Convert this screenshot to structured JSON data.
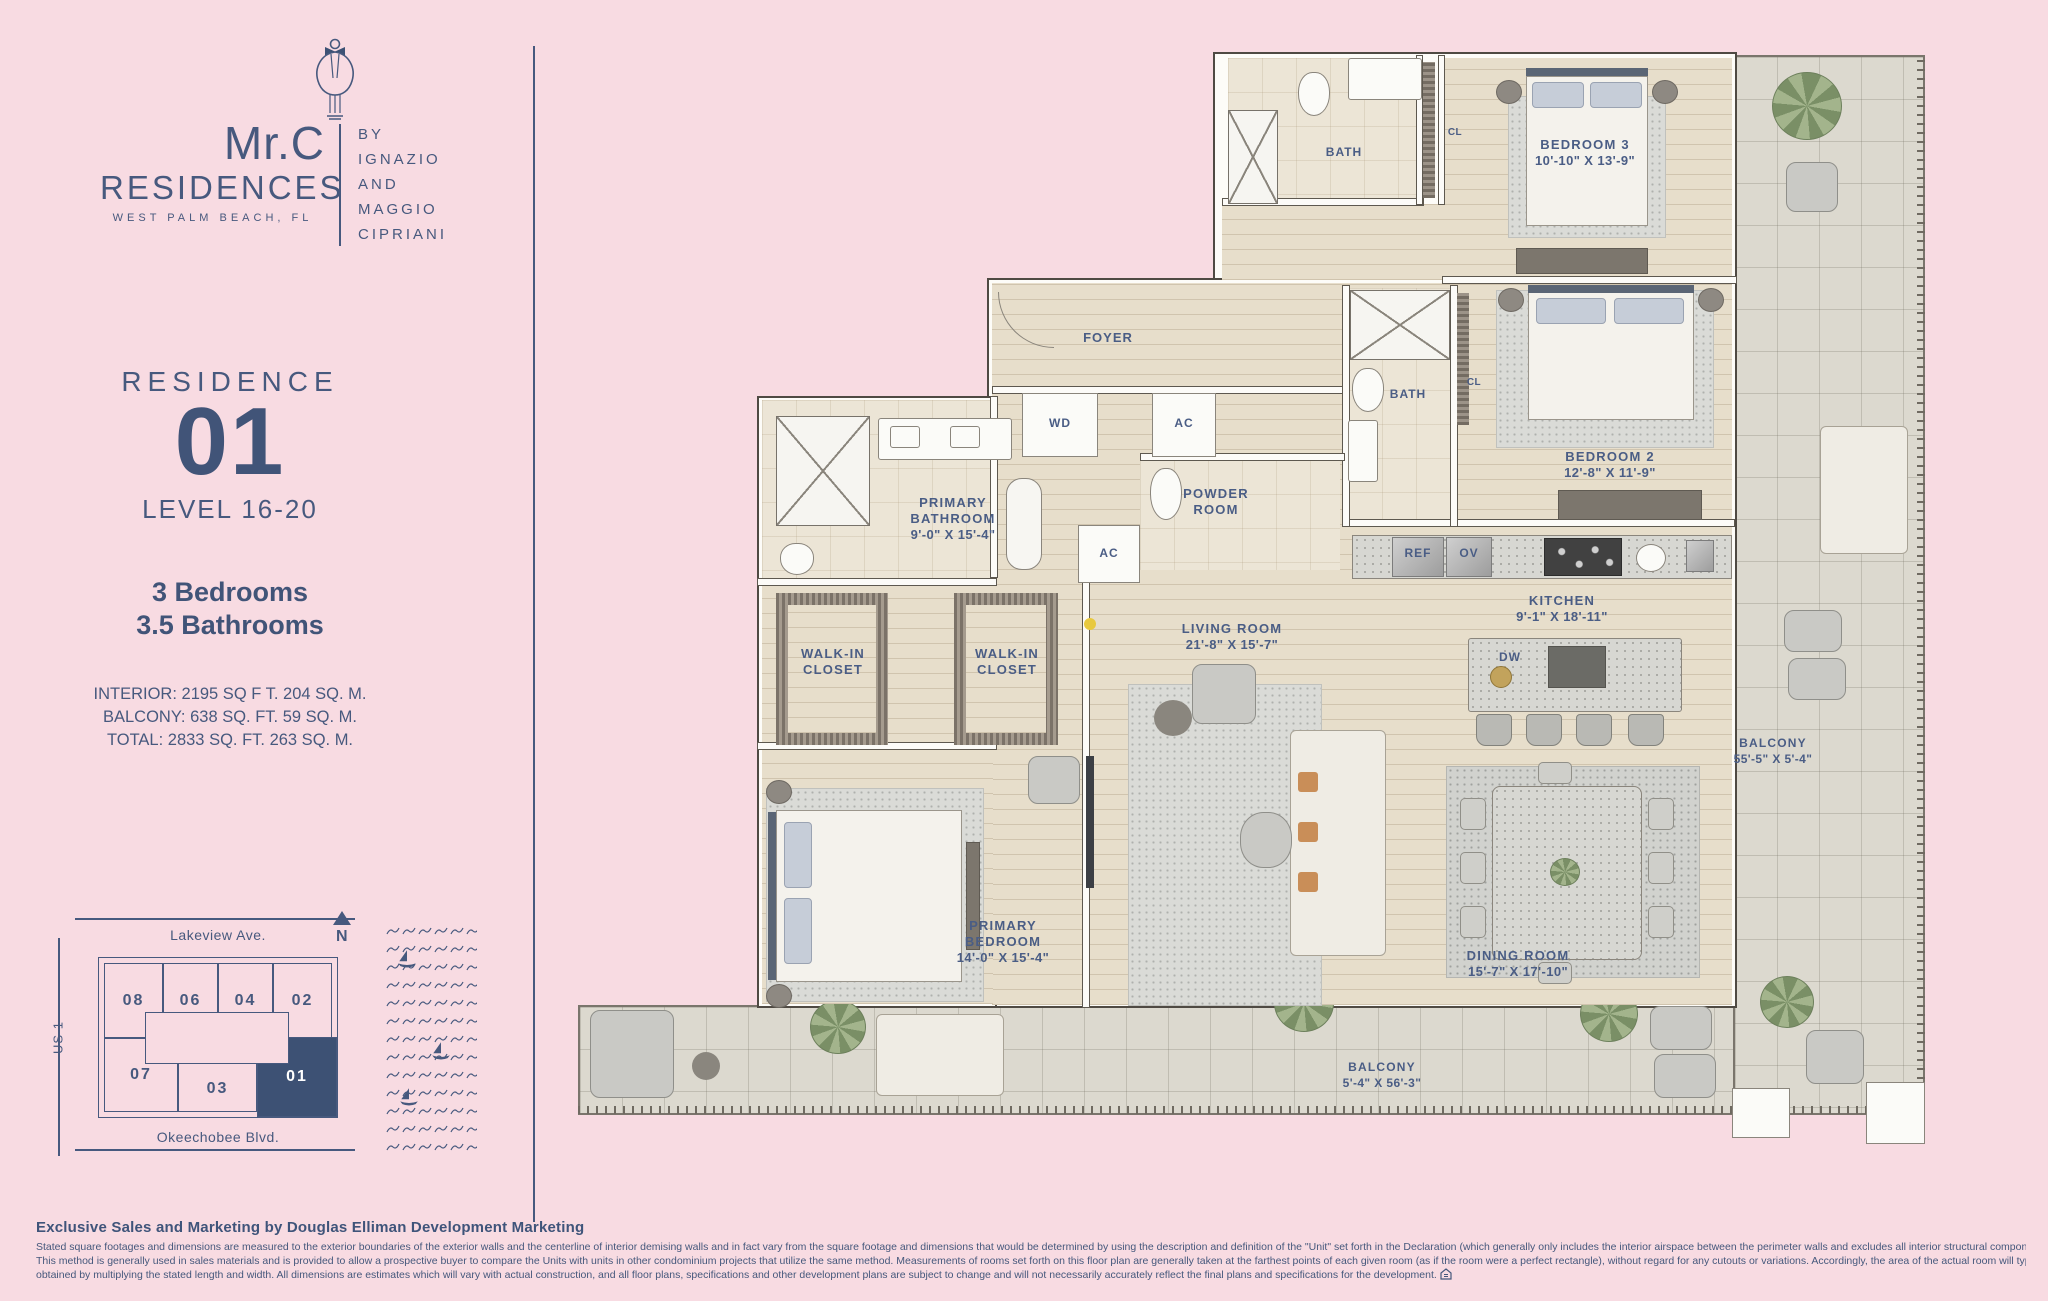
{
  "brand": {
    "name": "Mr.C",
    "residences": "RESIDENCES",
    "location": "WEST PALM BEACH, FL",
    "byline": [
      "BY",
      "IGNAZIO",
      "AND",
      "MAGGIO",
      "CIPRIANI"
    ]
  },
  "residence": {
    "label": "RESIDENCE",
    "number": "01",
    "level": "LEVEL 16-20",
    "bedrooms": "3 Bedrooms",
    "bathrooms": "3.5 Bathrooms",
    "interior": "INTERIOR: 2195 SQ F T. 204 SQ. M.",
    "balcony": "BALCONY: 638 SQ. FT. 59 SQ. M.",
    "total": "TOTAL: 2833 SQ. FT. 263 SQ. M."
  },
  "siteplan": {
    "street_top": "Lakeview Ave.",
    "street_left": "US 1",
    "street_bottom": "Okeechobee Blvd.",
    "north_label": "N",
    "units_top": [
      "08",
      "06",
      "04",
      "02"
    ],
    "units_bottom": [
      "07",
      "03",
      "01"
    ],
    "highlighted_unit": "01"
  },
  "floorplan": {
    "bath_top": "BATH",
    "cl_top": "CL",
    "bedroom3_name": "BEDROOM 3",
    "bedroom3_dims": "10'-10\" X 13'-9\"",
    "foyer": "FOYER",
    "wd": "WD",
    "ac1": "AC",
    "ac2": "AC",
    "powder_line1": "POWDER",
    "powder_line2": "ROOM",
    "primary_bath_line1": "PRIMARY",
    "primary_bath_line2": "BATHROOM",
    "primary_bath_dims": "9'-0\" X 15'-4\"",
    "bath2": "BATH",
    "cl2": "CL",
    "bedroom2_name": "BEDROOM 2",
    "bedroom2_dims": "12'-8\" X 11'-9\"",
    "kitchen_name": "KITCHEN",
    "kitchen_dims": "9'-1\" X 18'-11\"",
    "ref": "REF",
    "ov": "OV",
    "dw": "DW",
    "living_name": "LIVING ROOM",
    "living_dims": "21'-8\" X 15'-7\"",
    "wic1_line1": "WALK-IN",
    "wic1_line2": "CLOSET",
    "wic2_line1": "WALK-IN",
    "wic2_line2": "CLOSET",
    "primary_bed_line1": "PRIMARY",
    "primary_bed_line2": "BEDROOM",
    "primary_bed_dims": "14'-0\" X 15'-4\"",
    "dining_name": "DINING ROOM",
    "dining_dims": "15'-7\" X 17'-10\"",
    "balcony_right_name": "BALCONY",
    "balcony_right_dims": "55'-5\" X 5'-4\"",
    "balcony_bottom_name": "BALCONY",
    "balcony_bottom_dims": "5'-4\" X 56'-3\""
  },
  "footer": {
    "title": "Exclusive Sales and Marketing by Douglas Elliman Development Marketing",
    "line1": "Stated square footages and dimensions are measured to the exterior boundaries of the exterior walls and the centerline of interior demising walls and in fact vary from the square footage and dimensions that would be determined by using the description and definition of the \"Unit\" set forth in the Declaration (which generally only includes the interior airspace between the perimeter walls and excludes all interior structural components and other common elements).",
    "line2": "This method is generally used in sales materials and is provided to allow a prospective buyer to compare the Units with units in other condominium projects that utilize the same method. Measurements of rooms set forth on this floor plan are generally taken at the farthest points of each given room (as if the room were a perfect rectangle), without regard for any cutouts or variations.  Accordingly, the area of the actual room will typically be smaller than the product",
    "line3": "obtained by multiplying the stated length and width.  All dimensions are estimates which will vary with actual construction, and all floor plans, specifications and other development plans are subject to change and will not necessarily accurately reflect the final plans and specifications for the development."
  }
}
